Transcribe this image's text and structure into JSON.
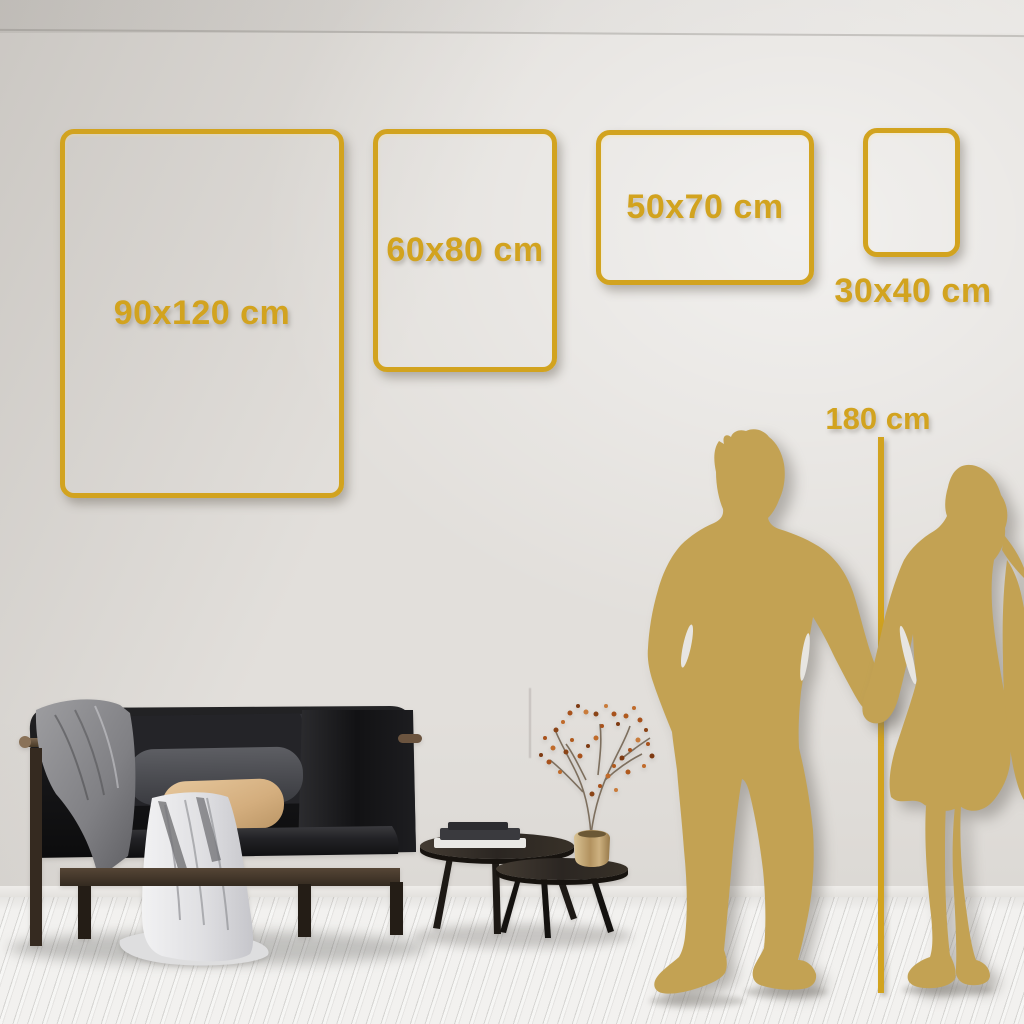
{
  "size_guide": {
    "frames": [
      {
        "label": "90x120 cm"
      },
      {
        "label": "60x80 cm"
      },
      {
        "label": "50x70 cm"
      },
      {
        "label": "30x40 cm"
      }
    ],
    "height_reference": {
      "label": "180 cm"
    }
  },
  "colors": {
    "accent_gold": "#D2A31F",
    "silhouette_gold": "#C3A253",
    "wall": "#E2DFDB",
    "floor": "#F2F1EF"
  }
}
